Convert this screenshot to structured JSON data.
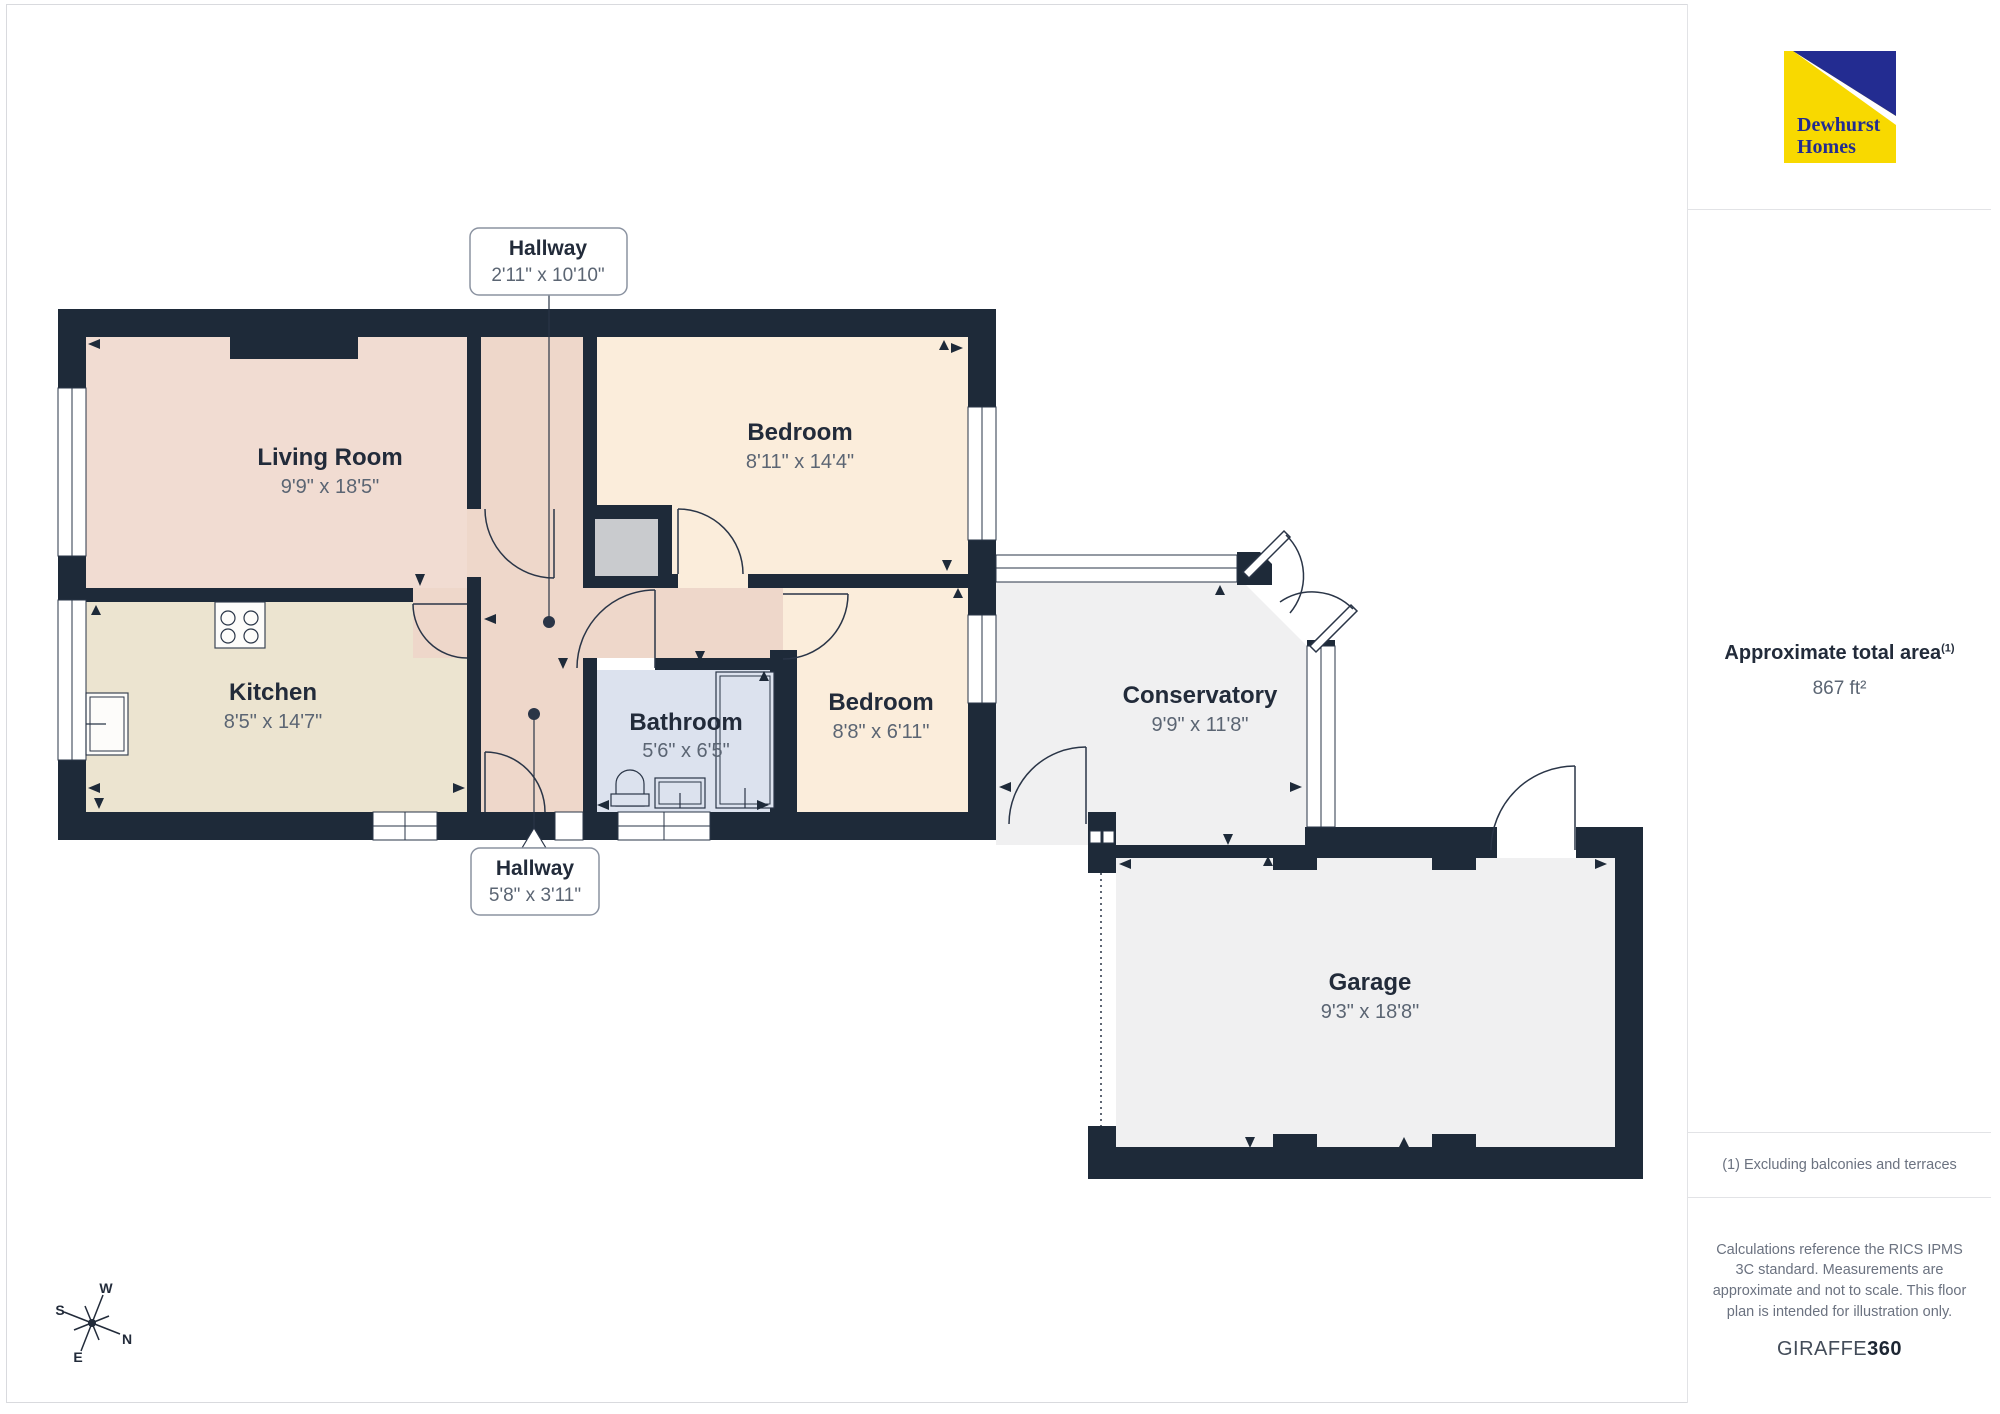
{
  "logo": {
    "line1": "Dewhurst",
    "line2": "Homes"
  },
  "sidebar": {
    "area_title": "Approximate total area",
    "area_sup": "(1)",
    "area_value": "867 ft²",
    "note": "(1) Excluding balconies and terraces",
    "disclaimer": "Calculations reference the RICS IPMS 3C standard. Measurements are approximate and not to scale. This floor plan is intended for illustration only.",
    "brand": "GIRAFFE",
    "brand_bold": "360"
  },
  "rooms": [
    {
      "name": "Living Room",
      "dims": "9'9\" x 18'5\""
    },
    {
      "name": "Kitchen",
      "dims": "8'5\" x 14'7\""
    },
    {
      "name": "Bedroom",
      "dims": "8'11\" x 14'4\""
    },
    {
      "name": "Bathroom",
      "dims": "5'6\" x 6'5\""
    },
    {
      "name": "Bedroom",
      "dims": "8'8\" x 6'11\""
    },
    {
      "name": "Conservatory",
      "dims": "9'9\" x 11'8\""
    },
    {
      "name": "Garage",
      "dims": "9'3\" x 18'8\""
    }
  ],
  "callouts": [
    {
      "name": "Hallway",
      "dims": "2'11\" x 10'10\""
    },
    {
      "name": "Hallway",
      "dims": "5'8\" x 3'11\""
    }
  ],
  "compass": {
    "n": "N",
    "s": "S",
    "e": "E",
    "w": "W"
  },
  "colors": {
    "wall": "#1e2a39",
    "living_room": "#f1dcd2",
    "kitchen": "#ece4d0",
    "bedroom": "#fbeddb",
    "bathroom": "#dce2ee",
    "hallway": "#eed7ca",
    "conservatory_garage": "#f0f0f1",
    "grey_block": "#c9cbce",
    "logo_yellow": "#f8d900",
    "logo_blue": "#232c91",
    "text_dark": "#222b3a",
    "text_grey": "#5b6573"
  }
}
